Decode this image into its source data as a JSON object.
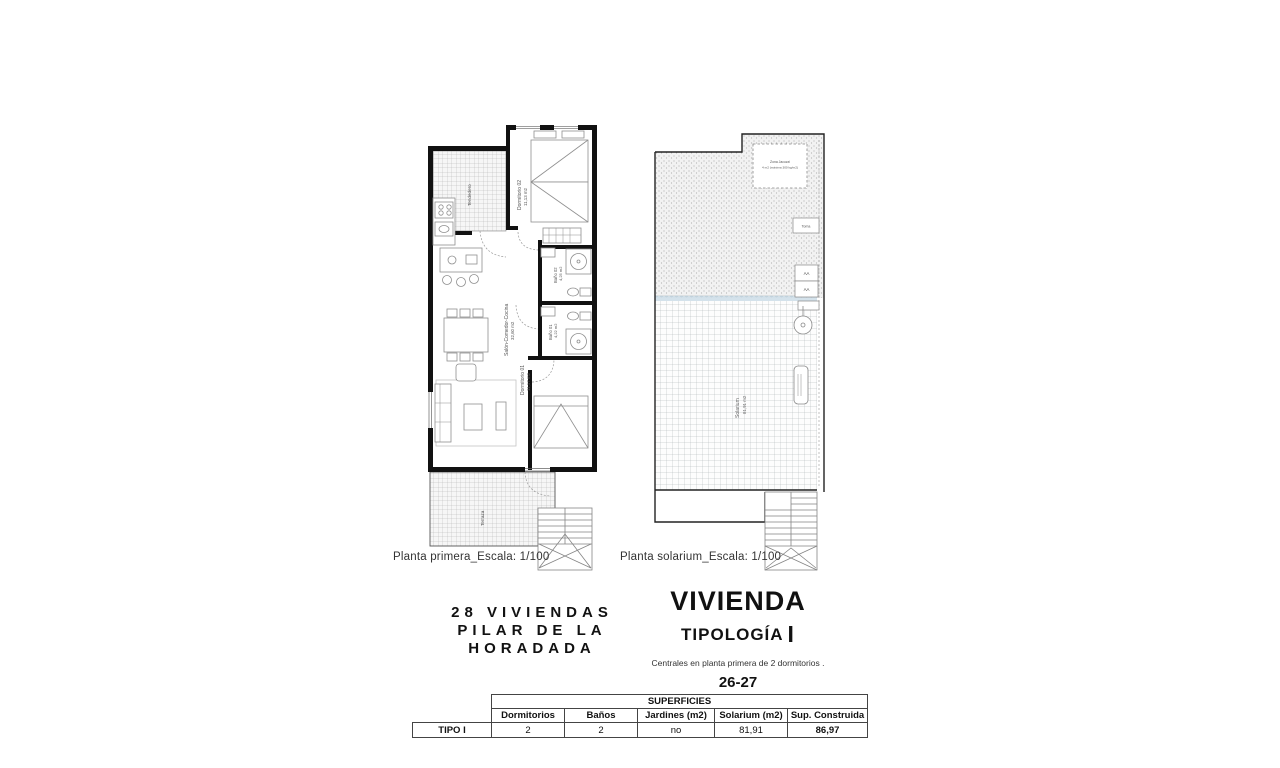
{
  "plans": {
    "primera": {
      "caption": "Planta primera_Escala: 1/100",
      "rooms": {
        "tendedero": "Tendedero",
        "dormitorio02": "Dormitorio 02",
        "dormitorio02_area": "11,13 m2",
        "bano02": "Baño 02",
        "bano02_area": "4,25 m2",
        "bano01": "Baño 01",
        "bano01_area": "4,22 m2",
        "dormitorio01": "Dormitorio 01",
        "dormitorio01_area": "11,17 m2",
        "salon": "Salón-Comedor-Cocina",
        "salon_area": "32,60 m2",
        "terraza": "Terraza"
      }
    },
    "solarium": {
      "caption": "Planta solarium_Escala: 1/100",
      "labels": {
        "zona_line1": "Zona Jacuzzi",
        "zona_line2": "4 m2 (máxima 300 kg/m2)",
        "toma": "Toma",
        "aa1": "AA",
        "aa2": "AA",
        "solarium": "Solarium",
        "solarium_area": "81,91 m2"
      }
    }
  },
  "title_block": {
    "project_line1": "28 VIVIENDAS",
    "project_line2": "PILAR DE LA",
    "project_line3": "HORADADA",
    "dwelling": "VIVIENDA",
    "typology": "TIPOLOGÍA",
    "typology_num": "I",
    "subtitle": "Centrales en planta primera de 2 dormitorios .",
    "units": "26-27"
  },
  "table": {
    "group_header": "SUPERFICIES",
    "row_label": "TIPO I",
    "columns": [
      "Dormitorios",
      "Baños",
      "Jardines (m2)",
      "Solarium (m2)",
      "Sup. Construida"
    ],
    "values": [
      "2",
      "2",
      "no",
      "81,91",
      "86,97"
    ]
  },
  "colors": {
    "wall": "#111111",
    "furniture_line": "#8f8f8f",
    "glass_strip": "#ccdde8"
  }
}
